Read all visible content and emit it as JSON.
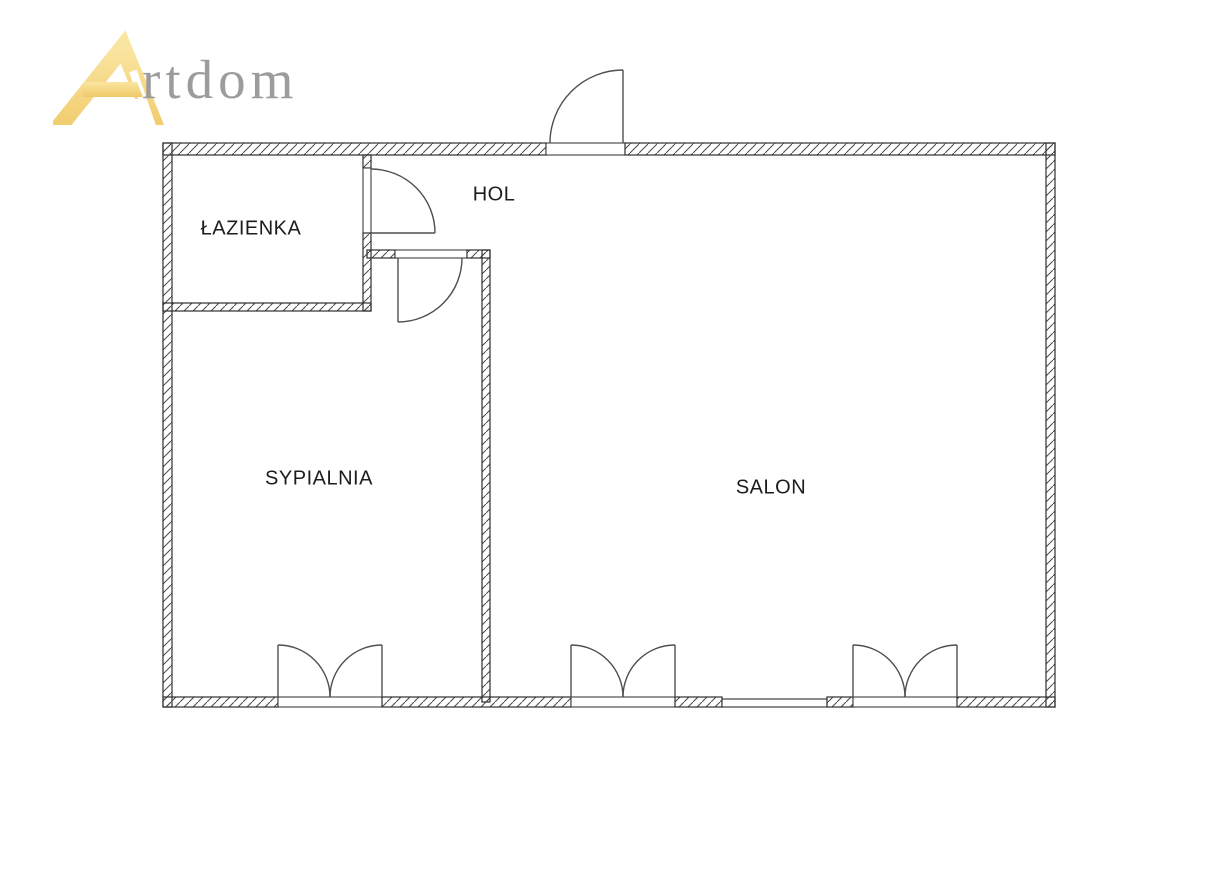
{
  "logo": {
    "brand": "Artdom",
    "text": "rtdom"
  },
  "rooms": {
    "bathroom": {
      "label": "ŁAZIENKA"
    },
    "hall": {
      "label": "HOL"
    },
    "bedroom": {
      "label": "SYPIALNIA"
    },
    "living_room": {
      "label": "SALON"
    }
  },
  "colors": {
    "gold_light": "#FAE5A0",
    "gold_dark": "#F0C968",
    "logo_text": "#9C9C9C",
    "wall_line": "#2E2E2E",
    "hatch_line": "#4A4A4A",
    "door_line": "#4F4F4F",
    "label_text": "#1C1C1C",
    "background": "#FFFFFF"
  }
}
